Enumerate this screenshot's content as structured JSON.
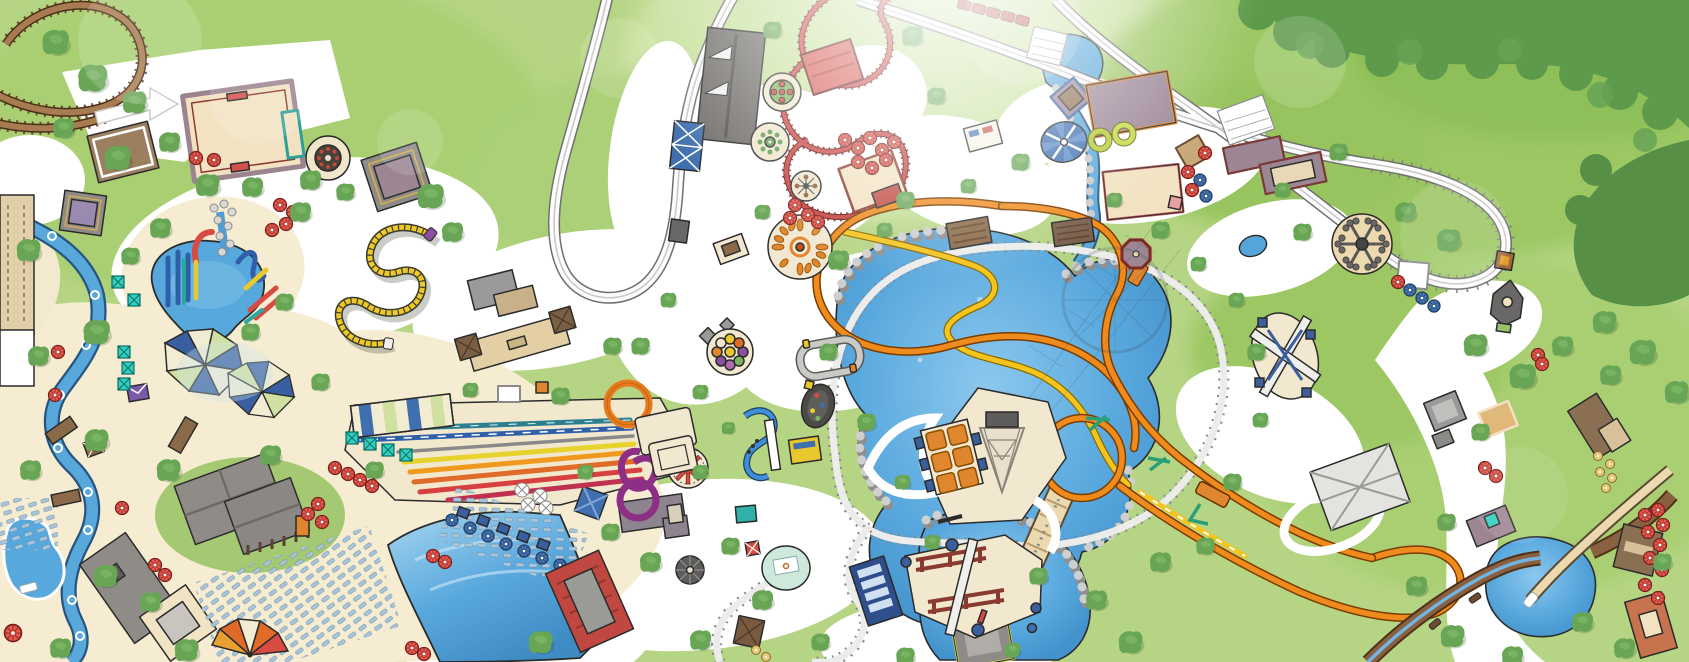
{
  "app": {
    "type": "Illustrated amusement-park map screenshot (top-down, hand-drawn style)",
    "visible_text": "none - the map artwork contains no readable text labels",
    "description": "Stylized overhead map of a theme park and water park: wooden coaster top-left, red kiddie coaster and grey racing track top-center, orange and yellow launch coaster with vertical loop around a central lake with an observation tower, railroad loop, white hyper-coaster turnaround on the right, log flume bottom-right, and a water park on the left with lazy river, splash pool, rainbow racer slides, loop slides, wave pool, cabanas and umbrellas."
  },
  "canvas": {
    "width": 1689,
    "height": 662
  },
  "palette": {
    "grass": "#b6d584",
    "grass_dark": "#9cc764",
    "forest": "#5d9a4b",
    "path": "#ffffff",
    "sand": "#f5ecd2",
    "water": "#56a5da",
    "water_deep": "#3f8cc4",
    "outline": "#2b2b2b",
    "wood_track": "#a87c50",
    "red_track": "#c8413d",
    "orange_track": "#ef8b1d",
    "yellow_track": "#f5c41f",
    "grey_track": "#fdfdfd",
    "rail": "#84898d",
    "roof_grey": "#8f8c88",
    "roof_mauve": "#9d8694",
    "roof_red": "#cc4a42",
    "roof_brown": "#8a6f52",
    "cream_building": "#f2e2c2",
    "teal_cabana": "#2fd0c0",
    "umbrella_red": "#e25a50",
    "umbrella_blue": "#4a78b8"
  },
  "features": {
    "wooden_coaster": {
      "name": "Wooden roller coaster (brown track, top left)"
    },
    "kiddie_coaster_red": {
      "name": "Red kiddie coaster with red station"
    },
    "racing_track_grey": {
      "name": "Grey racing / monorail loop with station"
    },
    "hyper_coaster_white": {
      "name": "White hyper coaster sweep and turnaround (right)"
    },
    "launch_coaster": {
      "name": "Orange and yellow launch coaster with vertical loop"
    },
    "caterpillar_coaster": {
      "name": "Yellow caterpillar wild-mouse coaster"
    },
    "kiddie_coaster_blue": {
      "name": "Blue spiral kiddie coaster"
    },
    "railroad": {
      "name": "Park railroad loop around the lake"
    },
    "train_red": {
      "name": "Red train on track (top)"
    },
    "central_lake": {
      "name": "Central lake with rocky shore"
    },
    "stream": {
      "name": "Stream with rock banks feeding the lake"
    },
    "observation_tower": {
      "name": "Observation tower base with lattice and orange panels"
    },
    "tower_shadow": {
      "name": "Shadow of tower and wheel cast over lake"
    },
    "lazy_river": {
      "name": "Lazy river with tubes (water park)"
    },
    "splash_pool": {
      "name": "Kids splash pool with colorful slides"
    },
    "rainbow_slides": {
      "name": "Rainbow racer mat slides"
    },
    "loop_slides": {
      "name": "Orange and purple looping body slides with tower"
    },
    "wave_pool": {
      "name": "Wave pool with red wave-machine building"
    },
    "kiddie_pool": {
      "name": "Small kiddie pool (bottom left)"
    },
    "log_flume": {
      "name": "Log flume with splash pond and drop chute (bottom right)"
    },
    "flume_station": {
      "name": "White hip-roof flume station"
    },
    "teacup_ride": {
      "name": "Tea-cup flat ride"
    },
    "flower_ride": {
      "name": "Round flower flat ride"
    },
    "small_spinner": {
      "name": "Small spinner flat ride"
    },
    "wave_swinger": {
      "name": "Wave swinger carousel (orange seats)"
    },
    "balloon_ride": {
      "name": "Balloon race ride (colored gondolas)"
    },
    "star_spinner": {
      "name": "Red star spinner ride"
    },
    "spider_ride": {
      "name": "Spider / octopus arm ride"
    },
    "swing_ride_blue": {
      "name": "Blue canopy swing ride"
    },
    "kiddie_car_track": {
      "name": "Kiddie car driving track"
    },
    "bumper_oval": {
      "name": "Oval bumper-car / racer pad"
    },
    "swing_structure": {
      "name": "Crossed-beam swing structure on pad"
    },
    "platform_ride": {
      "name": "Maroon frame platform ride with beam"
    },
    "grandstand": {
      "name": "Blue grandstand bleachers"
    },
    "carousel_house": {
      "name": "Dark hexagonal carousel house"
    },
    "gazebo_red": {
      "name": "Red-trimmed octagonal gazebo"
    },
    "station_grey": {
      "name": "Dark grey station building"
    },
    "purple_building": {
      "name": "Purple-roofed show building with orange trim"
    },
    "cream_building": {
      "name": "Cream building with red trim"
    },
    "lodge_buildings": {
      "name": "Grey-roofed lodge buildings (water park)"
    },
    "pavilion_row": {
      "name": "Tan pavilion with brown pyramid corners"
    },
    "shade_sails": {
      "name": "Pinwheel shade sails"
    },
    "cabanas": {
      "name": "Teal cabanas"
    },
    "canopy": {
      "name": "Striped shade canopy by slides"
    },
    "loungers": {
      "name": "Rows of lounge chairs"
    },
    "umbrellas": {
      "name": "Red and blue parasols / tables"
    },
    "giant_umbrella": {
      "name": "Large orange-red umbrella"
    },
    "bridge": {
      "name": "Wooden bridge over lake arm"
    },
    "trees": {
      "name": "Trees and forest"
    }
  }
}
